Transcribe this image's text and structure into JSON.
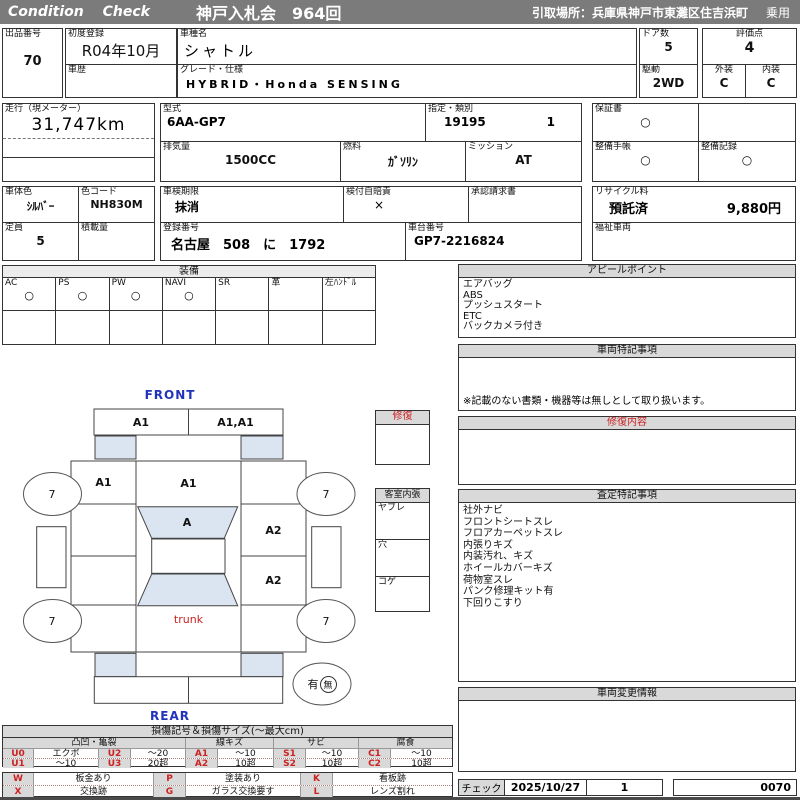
{
  "header": {
    "brand": "Condition Check",
    "auction_title": "神戸入札会　964回",
    "pickup_location": "引取場所：兵庫県神戸市東灘区住吉浜町",
    "usage": "乗用"
  },
  "info": {
    "lot_label": "出品番号",
    "lot_no": "70",
    "first_reg_label": "初度登録",
    "first_reg": "R04年10月",
    "history_label": "車歴",
    "model_label": "車種名",
    "model": "シャトル",
    "grade_label": "グレード・仕様",
    "grade": "HYBRID・Honda SENSING",
    "doors_label": "ドア数",
    "doors": "5",
    "drive_label": "駆動",
    "drive": "2WD",
    "score_label": "評価点",
    "score": "4",
    "exterior_label": "外装",
    "exterior": "C",
    "interior_label": "内装",
    "interior": "C",
    "mileage_label": "走行（現メーター）",
    "mileage": "31,747km",
    "model_code_label": "型式",
    "model_code": "6AA-GP7",
    "class_label": "指定・類別",
    "class_no": "19195",
    "class_sub": "1",
    "warranty_label": "保証書",
    "warranty": "○",
    "displacement_label": "排気量",
    "displacement": "1500CC",
    "fuel_label": "燃料",
    "fuel": "ｶﾞｿﾘﾝ",
    "transmission_label": "ミッション",
    "transmission": "AT",
    "maintenance_book_label": "整備手帳",
    "maintenance_book": "○",
    "maintenance_record_label": "整備記録",
    "maintenance_record": "○",
    "body_color_label": "車体色",
    "body_color": "ｼﾙﾊﾞｰ",
    "color_code_label": "色コード",
    "color_code": "NH830M",
    "inspection_label": "車検期限",
    "inspection": "抹消",
    "insurance_label": "検付自賠責",
    "insurance": "×",
    "approval_label": "承認請求書",
    "recycle_label": "リサイクル料",
    "recycle_status": "預託済",
    "recycle_fee": "9,880円",
    "capacity_label": "定員",
    "capacity": "5",
    "load_label": "積載量",
    "plate_label": "登録番号",
    "plate_no": "名古屋　508　に　1792",
    "vin_label": "車台番号",
    "vin": "GP7-2216824",
    "welfare_label": "福祉車両"
  },
  "equipment": {
    "title": "装備",
    "items": [
      {
        "label": "AC",
        "mark": "○"
      },
      {
        "label": "PS",
        "mark": "○"
      },
      {
        "label": "PW",
        "mark": "○"
      },
      {
        "label": "NAVI",
        "mark": "○"
      },
      {
        "label": "SR",
        "mark": ""
      },
      {
        "label": "革",
        "mark": ""
      },
      {
        "label": "左ﾊﾝﾄﾞﾙ",
        "mark": ""
      }
    ]
  },
  "appeal": {
    "title": "アピールポイント",
    "items": [
      "エアバッグ",
      "ABS",
      "プッシュスタート",
      "ETC",
      "バックカメラ付き"
    ]
  },
  "vehicle_notes": {
    "title": "車両特記事項",
    "note": "※記載のない書類・機器等は無しとして取り扱います。"
  },
  "repair_detail": {
    "title": "修復内容"
  },
  "assessment_notes": {
    "title": "査定特記事項",
    "items": [
      "社外ナビ",
      "フロントシートスレ",
      "フロアカーペットスレ",
      "内張りキズ",
      "内装汚れ、キズ",
      "ホイールカバーキズ",
      "荷物室スレ",
      "パンク修理キット有",
      "下回りこすり"
    ]
  },
  "change_info": {
    "title": "車両変更情報"
  },
  "check_row": {
    "label": "チェック",
    "date": "2025/10/27",
    "count": "1",
    "page_no": "0070"
  },
  "repair_box": {
    "title": "修復"
  },
  "cabin_box": {
    "title": "客室内張",
    "rows": [
      "ヤブレ",
      "穴",
      "コゲ"
    ]
  },
  "diagram": {
    "front_label": "FRONT",
    "rear_label": "REAR",
    "trunk_label": "trunk",
    "front_bumper_left": "A1",
    "front_bumper_right": "A1,A1",
    "left_fender": "A1",
    "hood": "A1",
    "windshield": "A",
    "right_front_door": "A2",
    "right_rear_door": "A2",
    "wheel_front_left": "7",
    "wheel_front_right": "7",
    "wheel_rear_left": "7",
    "wheel_rear_right": "7",
    "spare_has": "有",
    "spare_none": "無"
  },
  "legend": {
    "title": "損傷記号＆損傷サイズ(～最大cm)",
    "groups": [
      "凸凹・亀裂",
      "線キズ",
      "サビ",
      "腐食"
    ],
    "row1": [
      "U0",
      "エクボ",
      "U2",
      "～20",
      "A1",
      "～10",
      "S1",
      "～10",
      "C1",
      "～10"
    ],
    "row2": [
      "U1",
      "～10",
      "U3",
      "20超",
      "A2",
      "10超",
      "S2",
      "10超",
      "C2",
      "10超"
    ],
    "row3": [
      "W",
      "板金あり",
      "P",
      "塗装あり",
      "K",
      "看板跡"
    ],
    "row4": [
      "X",
      "交換跡",
      "G",
      "ガラス交換要す",
      "L",
      "レンズ割れ"
    ]
  },
  "colors": {
    "header_bar": "#7b7b7b",
    "section_header_bg": "#d9d9d9",
    "glass_fill": "#dbe5f1",
    "accent_red": "#cc2222",
    "accent_blue": "#2233bb"
  }
}
